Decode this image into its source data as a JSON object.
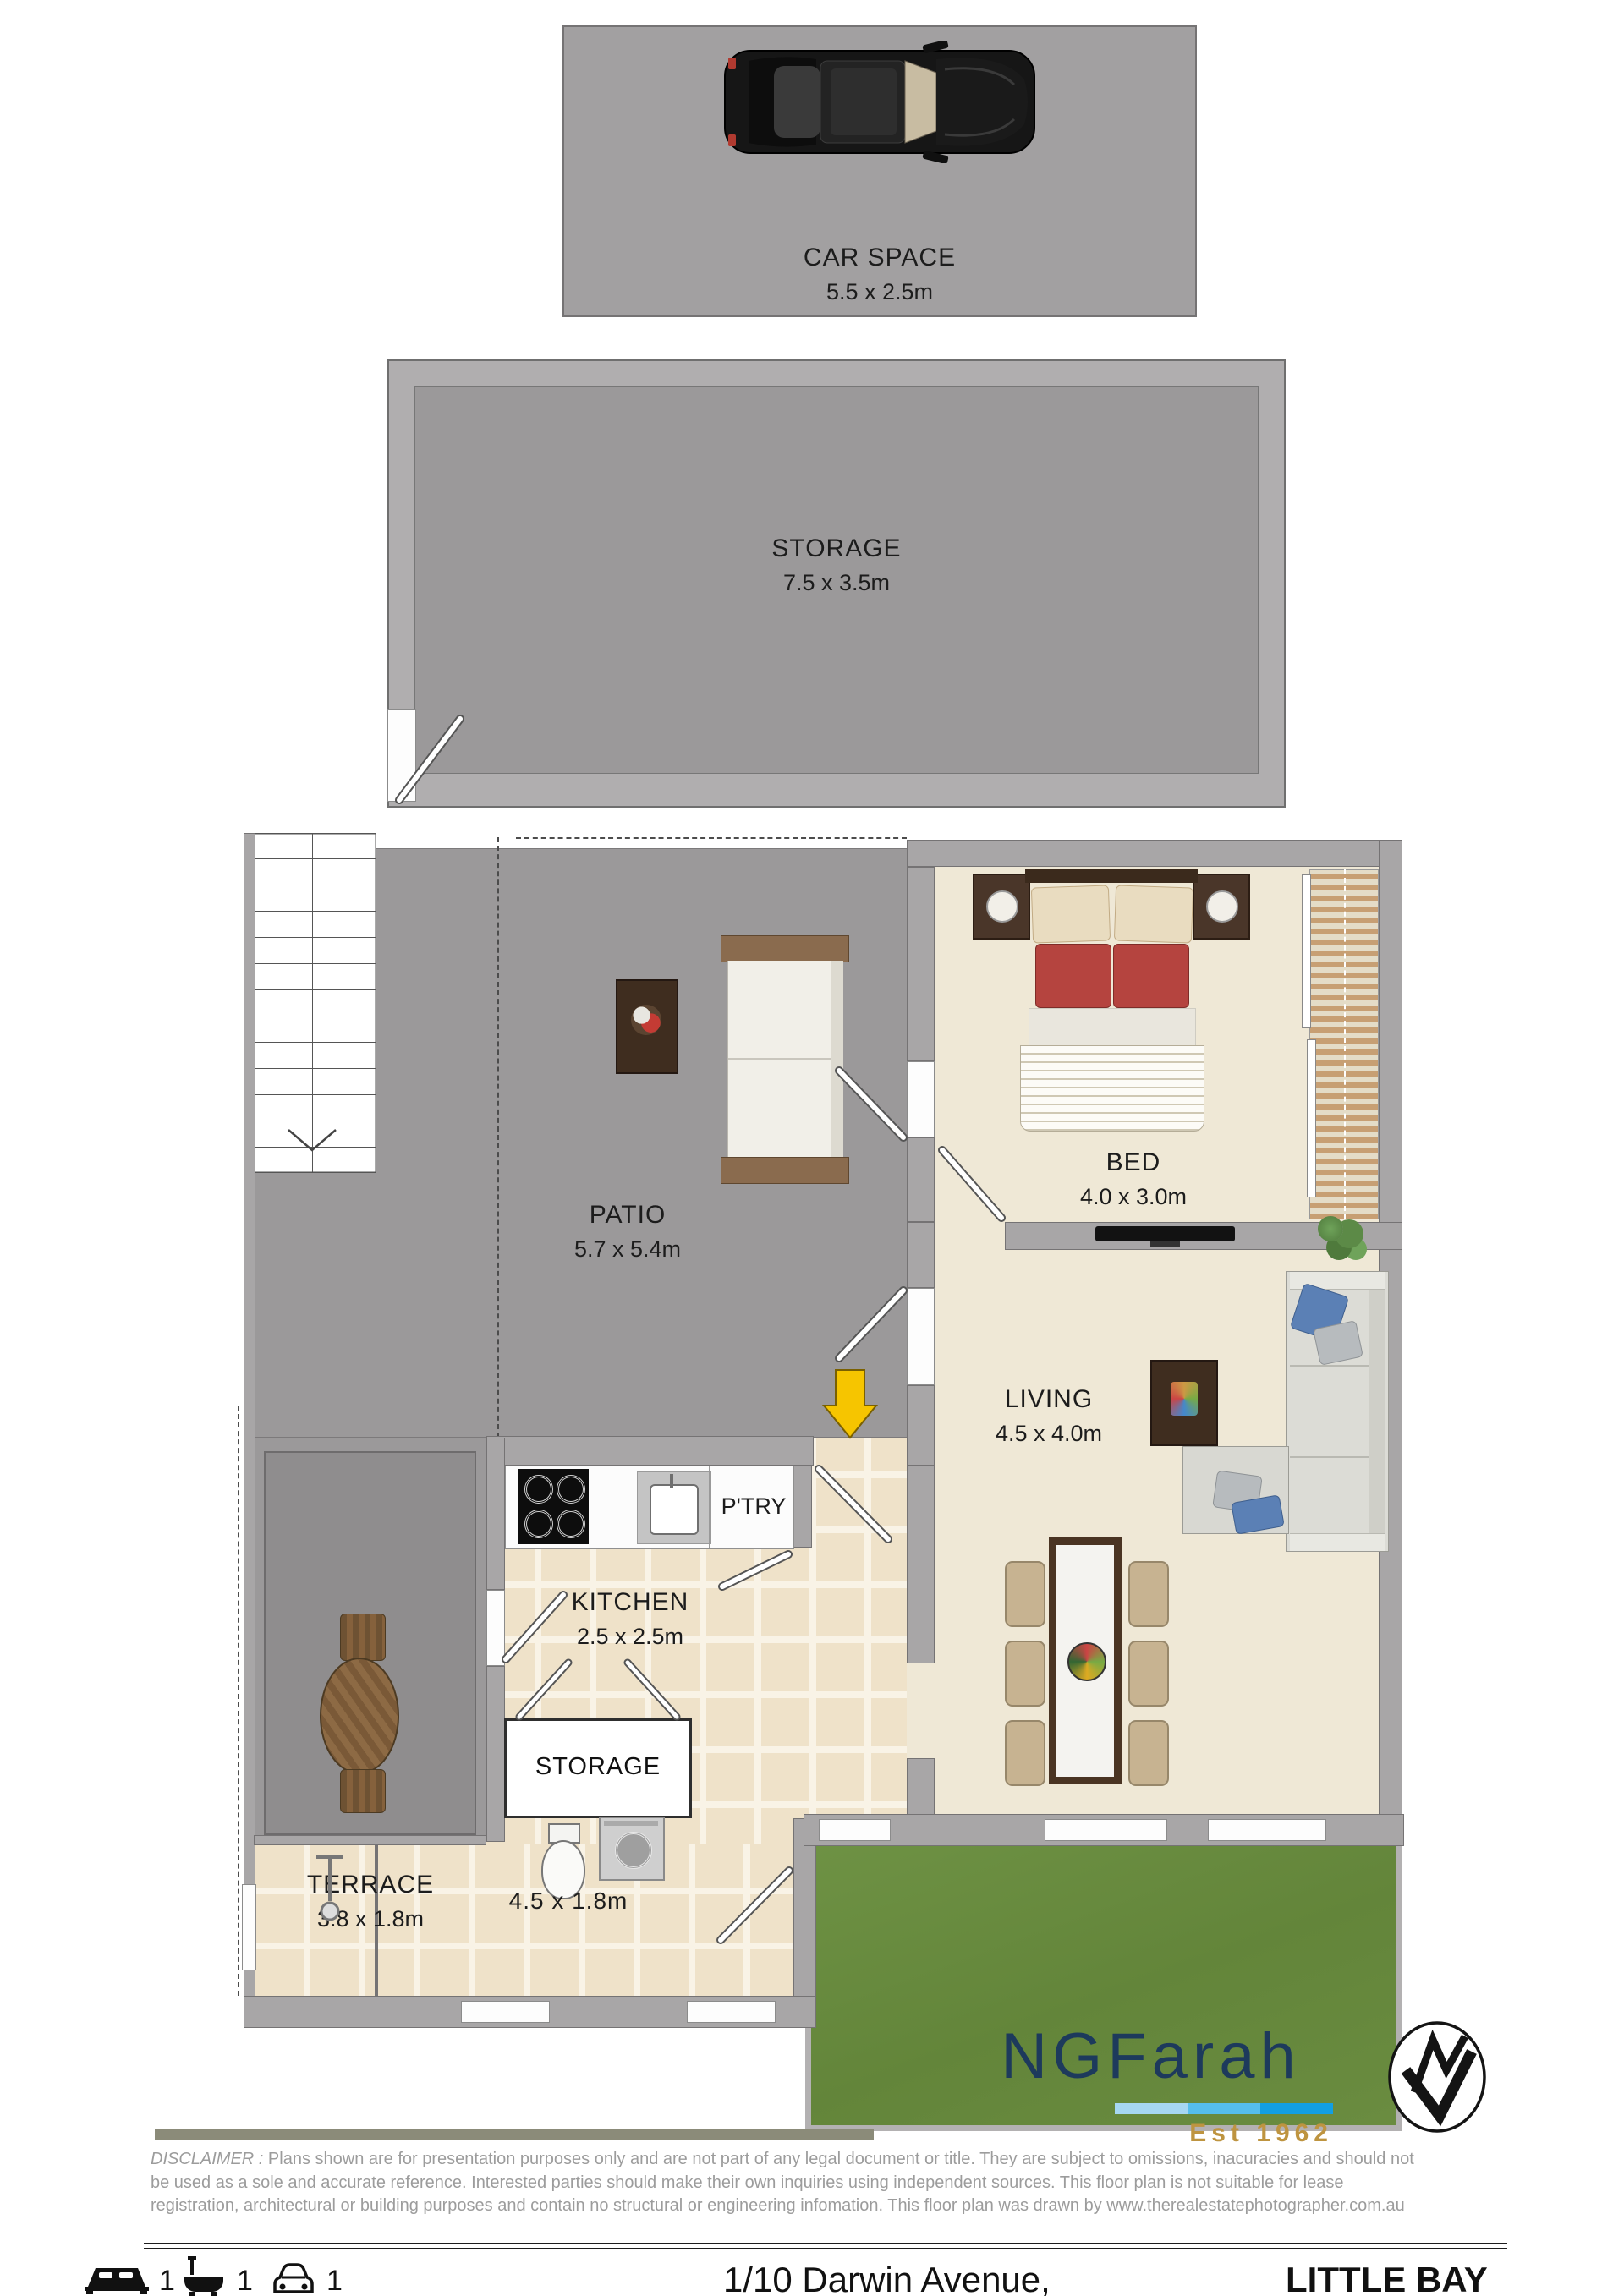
{
  "car_space": {
    "label": "CAR SPACE",
    "dimensions": "5.5 x 2.5m"
  },
  "storage_room": {
    "label": "STORAGE",
    "dimensions": "7.5 x 3.5m"
  },
  "rooms": {
    "patio": {
      "label": "PATIO",
      "dimensions": "5.7 x 5.4m"
    },
    "bed": {
      "label": "BED",
      "dimensions": "4.0 x 3.0m"
    },
    "living": {
      "label": "LIVING",
      "dimensions": "4.5 x 4.0m"
    },
    "kitchen": {
      "label": "KITCHEN",
      "dimensions": "2.5 x 2.5m"
    },
    "pantry": {
      "label": "P'TRY"
    },
    "storage_cupboard": {
      "label": "STORAGE"
    },
    "terrace": {
      "label": "TERRACE",
      "dimensions": "3.8 x 1.8m"
    },
    "laundry": {
      "dimensions": "4.5 x 1.8m"
    }
  },
  "branding": {
    "agency": "NGFarah",
    "established": "Est 1962",
    "navy": "#1D3A5C",
    "gold": "#BE9440",
    "underline_colors": [
      "#A6D7F2",
      "#55BEEC",
      "#129FE3"
    ]
  },
  "disclaimer": {
    "label": "DISCLAIMER :",
    "line1": "Plans shown are for presentation purposes only and are not part of any legal document or title. They are subject to omissions, inacuracies  and should not",
    "line2": "be  used  as  a  sole  and  accurate  reference.  Interested  parties  should  make  their  own  inquiries  using independent sources. This floor plan is not  suitable for  lease",
    "line3": "registration, architectural or building purposes and contain no structural or engineering infomation. This floor plan was  drawn  by www.therealestatephotographer.com.au"
  },
  "footer": {
    "bedrooms": "1",
    "bathrooms": "1",
    "car_spaces": "1",
    "address": "1/10 Darwin Avenue,",
    "suburb": "LITTLE BAY"
  },
  "palette": {
    "wall": "#A8A6A7",
    "patio_floor": "#9B999A",
    "interior_floor": "#EFE8D6",
    "tile_floor": "#EFE2C9",
    "grass": "#6B8F40"
  }
}
